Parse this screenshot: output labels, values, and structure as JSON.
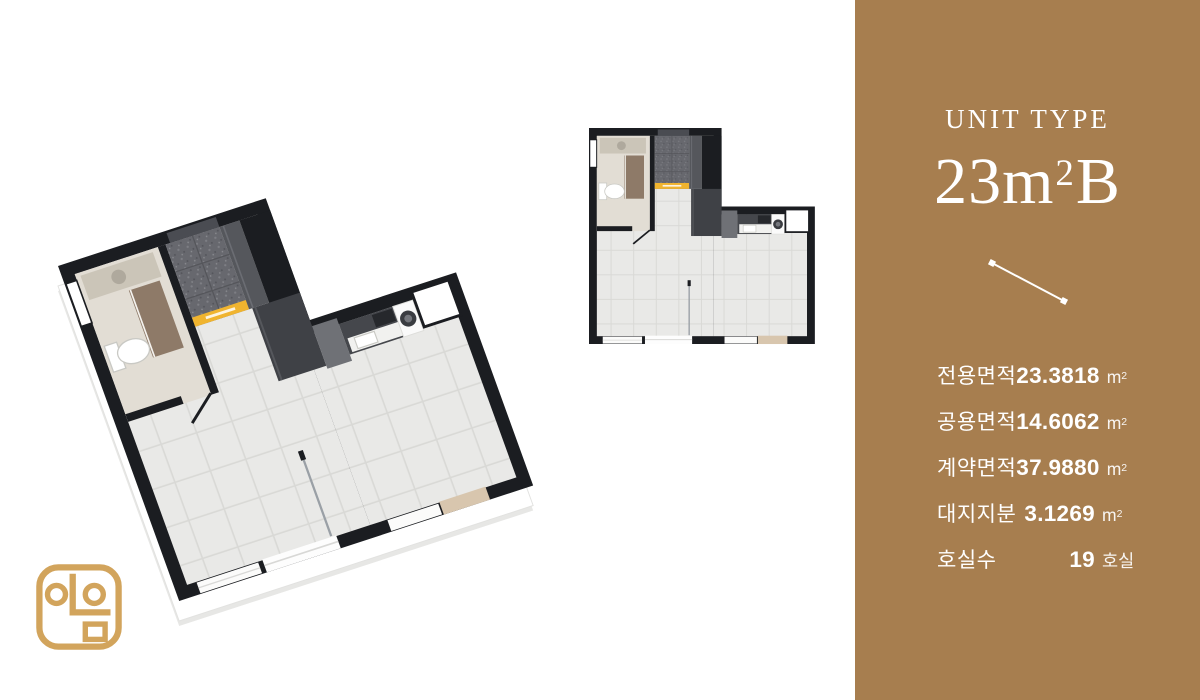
{
  "sidebar": {
    "bg_color": "#A77E4F",
    "text_color": "#FFFFFF",
    "unit_type_label": "UNIT TYPE",
    "unit_size": {
      "base": "23m",
      "sup": "2",
      "suffix": "B"
    },
    "specs": [
      {
        "label": "전용면적",
        "value": "23.3818",
        "unit": "m",
        "unit_sup": "2"
      },
      {
        "label": "공용면적",
        "value": "14.6062",
        "unit": "m",
        "unit_sup": "2"
      },
      {
        "label": "계약면적",
        "value": "37.9880",
        "unit": "m",
        "unit_sup": "2"
      },
      {
        "label": "대지지분",
        "value": "3.1269",
        "unit": "m",
        "unit_sup": "2"
      },
      {
        "label": "호실수",
        "value": "19",
        "unit": "호실",
        "unit_sup": ""
      }
    ]
  },
  "floorplan": {
    "view_3d": "3d-isometric-floor-plan",
    "view_2d": "2d-top-down-floor-plan",
    "wall_color": "#1B1D21",
    "tile_color": "#E9E9E7",
    "entry_mat_color": "#F0B42F",
    "door_sill_color": "#D8C6AE"
  },
  "logo": {
    "name": "ieum-brand-mark",
    "color": "#D2A45C"
  }
}
